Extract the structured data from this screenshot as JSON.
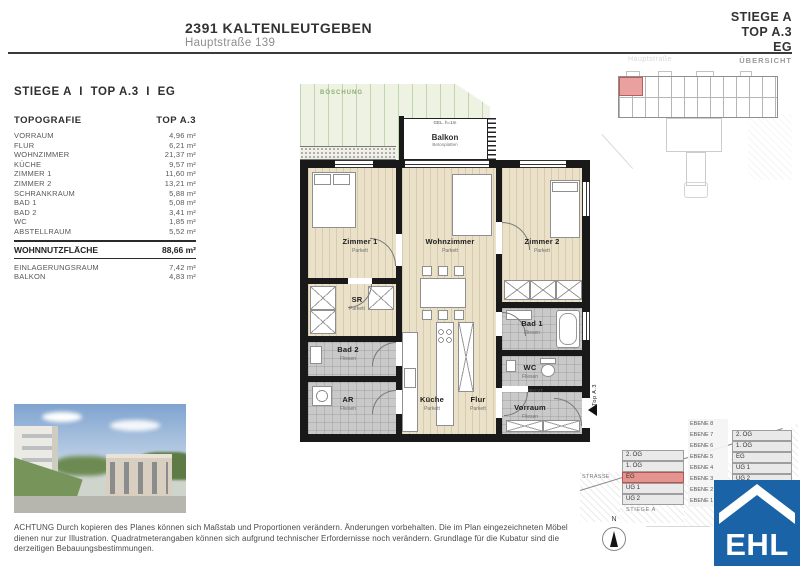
{
  "header": {
    "project": "2391 KALTENLEUTGEBEN",
    "address": "Hauptstraße 139",
    "stiege": "STIEGE A",
    "top": "TOP A.3",
    "floor": "EG"
  },
  "overview": {
    "street": "Hauptstraße",
    "label": "ÜBERSICHT"
  },
  "panel": {
    "title": "STIEGE A  I  TOP A.3  I  EG",
    "col_left": "TOPOGRAFIE",
    "col_right": "TOP A.3",
    "rows": [
      {
        "label": "VORRAUM",
        "value": "4,96 m²"
      },
      {
        "label": "FLUR",
        "value": "6,21 m²"
      },
      {
        "label": "WOHNZIMMER",
        "value": "21,37 m²"
      },
      {
        "label": "KÜCHE",
        "value": "9,57 m²"
      },
      {
        "label": "ZIMMER 1",
        "value": "11,60 m²"
      },
      {
        "label": "ZIMMER 2",
        "value": "13,21 m²"
      },
      {
        "label": "SCHRANKRAUM",
        "value": "5,88 m²"
      },
      {
        "label": "BAD 1",
        "value": "5,08 m²"
      },
      {
        "label": "BAD 2",
        "value": "3,41 m²"
      },
      {
        "label": "WC",
        "value": "1,85 m²"
      },
      {
        "label": "ABSTELLRAUM",
        "value": "5,52 m²"
      }
    ],
    "total": {
      "label": "WOHNNUTZFLÄCHE",
      "value": "88,66 m²"
    },
    "extras": [
      {
        "label": "EINLAGERUNGSRAUM",
        "value": "7,42 m²"
      },
      {
        "label": "BALKON",
        "value": "4,83 m²"
      }
    ]
  },
  "plan": {
    "boeschung": "BÖSCHUNG",
    "balkon": {
      "name": "Balkon",
      "sub": "Betonplatten",
      "rail": "GEL. h=1m"
    },
    "rooms": {
      "zimmer1": {
        "name": "Zimmer 1",
        "sub": "Parkett"
      },
      "wohnzimmer": {
        "name": "Wohnzimmer",
        "sub": "Parkett"
      },
      "zimmer2": {
        "name": "Zimmer 2",
        "sub": "Parkett"
      },
      "sr": {
        "name": "SR",
        "sub": "Parkett"
      },
      "bad2": {
        "name": "Bad 2",
        "sub": "Fliesen"
      },
      "ar": {
        "name": "AR",
        "sub": "Fliesen"
      },
      "kueche": {
        "name": "Küche",
        "sub": "Parkett"
      },
      "flur": {
        "name": "Flur",
        "sub": "Parkett"
      },
      "bad1": {
        "name": "Bad 1",
        "sub": "Fliesen"
      },
      "wc": {
        "name": "WC",
        "sub": "Fliesen"
      },
      "vorraum": {
        "name": "Vorraum",
        "sub": "Fliesen"
      }
    },
    "entry": "Top A.3",
    "shaft": "RH+VT"
  },
  "section": {
    "left_stack": [
      {
        "label": "2. OG"
      },
      {
        "label": "1. OG"
      },
      {
        "label": "EG",
        "cls": "hl"
      },
      {
        "label": "UG 1"
      },
      {
        "label": "UG 2"
      }
    ],
    "ebenen": [
      "EBENE 8",
      "EBENE 7",
      "EBENE 6",
      "EBENE 5",
      "EBENE 4",
      "EBENE 3",
      "EBENE 2",
      "EBENE 1"
    ],
    "right_stack": [
      {
        "label": "2. OG"
      },
      {
        "label": "1. OG"
      },
      {
        "label": "EG"
      },
      {
        "label": "UG 1"
      },
      {
        "label": "UG 2"
      }
    ],
    "strasse": "STRASSE",
    "stiege": "STIEGE A"
  },
  "compass": {
    "north": "N"
  },
  "footer": {
    "disclaimer": "ACHTUNG Durch kopieren des Planes können sich Maßstab und Proportionen verändern. Änderungen vorbehalten. Die im Plan eingezeichneten Möbel dienen nur zur Illustration. Quadratmeterangaben können sich aufgrund technischer Erfordernisse noch verändern. Grundlage für die Kubatur sind die derzeitigen Bebauungsbestimmungen."
  },
  "logo": {
    "text": "EHL"
  },
  "colors": {
    "accent_pink": "#e5938f",
    "parquet": "#eae1c8",
    "tile": "#c9c9c9",
    "wall": "#191919",
    "green_label": "#8fae70",
    "logo_blue": "#1a63a7"
  }
}
